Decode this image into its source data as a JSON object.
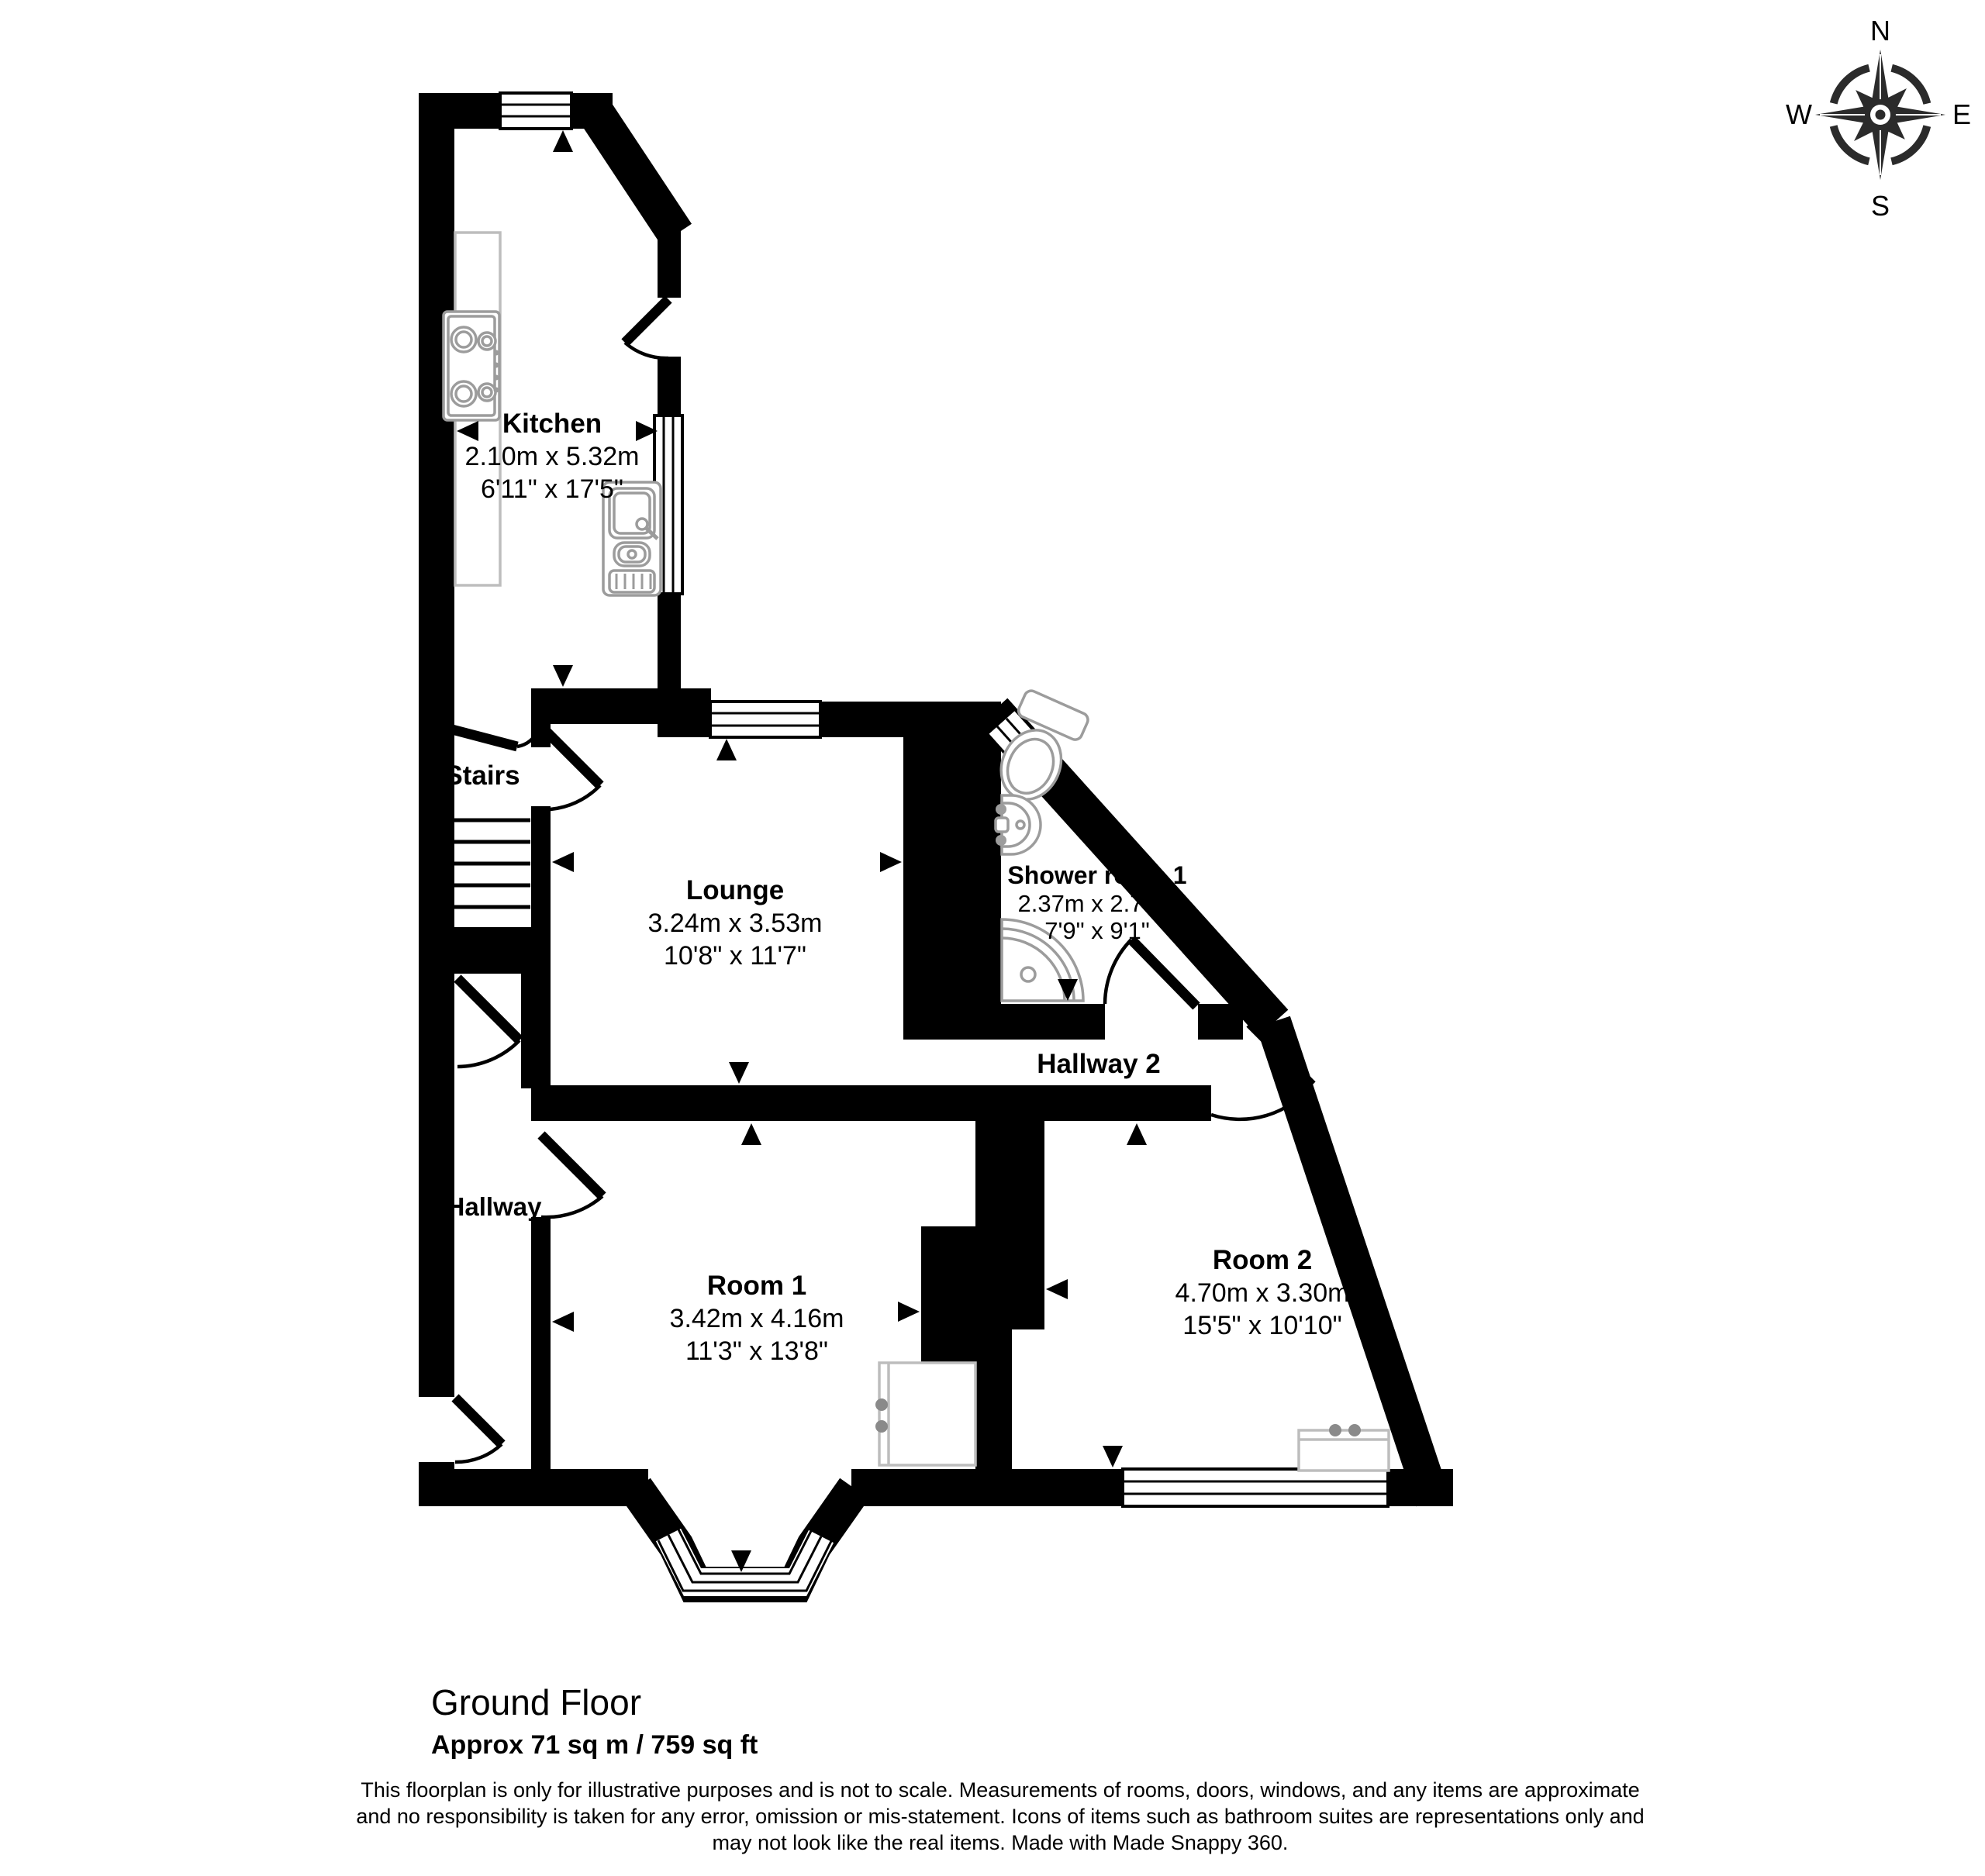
{
  "compass": {
    "north": "N",
    "east": "E",
    "south": "S",
    "west": "W"
  },
  "rooms": {
    "kitchen": {
      "name": "Kitchen",
      "metric": "2.10m x 5.32m",
      "imperial": "6'11\" x 17'5\""
    },
    "stairs": {
      "name": "Stairs"
    },
    "lounge": {
      "name": "Lounge",
      "metric": "3.24m x 3.53m",
      "imperial": "10'8\" x 11'7\""
    },
    "shower_room": {
      "name": "Shower room 1",
      "metric": "2.37m x 2.77m",
      "imperial": "7'9\" x 9'1\""
    },
    "hallway2": {
      "name": "Hallway 2"
    },
    "hallway": {
      "name": "Hallway"
    },
    "room1": {
      "name": "Room 1",
      "metric": "3.42m x 4.16m",
      "imperial": "11'3\" x 13'8\""
    },
    "room2": {
      "name": "Room 2",
      "metric": "4.70m x 3.30m",
      "imperial": "15'5\" x 10'10\""
    }
  },
  "footer": {
    "floor_title": "Ground Floor",
    "floor_area": "Approx 71 sq m / 759 sq ft",
    "disclaimer": [
      "This floorplan is only for illustrative purposes and is not to scale. Measurements of rooms, doors, windows, and any items are approximate",
      "and no responsibility is taken for any error, omission or mis-statement. Icons of items such as bathroom suites are representations only and",
      "may not look like the real items. Made with Made Snappy 360."
    ]
  },
  "colors": {
    "walls": "#000000",
    "fixtures": "#9c9c9c",
    "furniture": "#bdbdbd"
  }
}
